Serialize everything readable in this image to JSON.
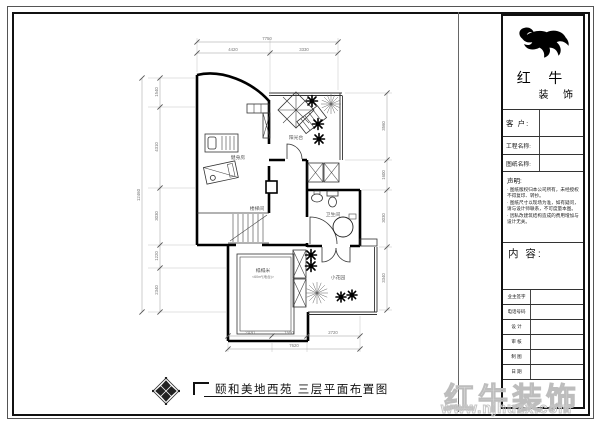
{
  "title_block": {
    "brand": {
      "line1": "红 牛",
      "line2": "装 饰"
    },
    "fields": [
      {
        "label": "客 户:"
      },
      {
        "label": "工程名称:"
      },
      {
        "label": "图纸名称:"
      }
    ],
    "statement": {
      "title": "声明:",
      "items": [
        "图纸版权归本公司所有，未经授权不得复印、转抄。",
        "图纸尺寸以现场为准，如有疑问，请与设计师联系，不可度量本图。",
        "因私改建筑结构造成的费用增加与设计无关。"
      ]
    },
    "content_label": "内 容:",
    "sign_rows": [
      {
        "label": "业主签字"
      },
      {
        "label": "电话号码"
      },
      {
        "label": "设 计"
      },
      {
        "label": "审 核"
      },
      {
        "label": "制 图"
      },
      {
        "label": "日 期"
      }
    ]
  },
  "plan": {
    "rooms": {
      "gym": "健身房",
      "terrace": "阳光台",
      "stairs": "楼梯间",
      "bathroom": "卫生间",
      "tatami": "榻榻米",
      "tatami_note": "<60m²(地台)>",
      "garden": "小花园"
    },
    "dims": {
      "top": {
        "overall": "7750",
        "seg1": "4420",
        "seg2": "3330"
      },
      "bottom": {
        "overall": "7620",
        "seg1": "2430",
        "seg2": "1590",
        "seg3": "2720"
      },
      "left": {
        "overall": "12460",
        "seg1": "1540",
        "seg2": "4310",
        "seg3": "3030",
        "seg4": "1220",
        "seg5": "2340"
      },
      "right": {
        "seg1": "3560",
        "seg2": "1600",
        "seg3": "3030",
        "seg4": "3340"
      }
    }
  },
  "footer": {
    "drawing_title": "颐和美地西苑  三层平面布置图"
  },
  "watermark": {
    "brand": "红牛装饰",
    "url": "www.njhuzx.com"
  },
  "colors": {
    "line": "#111111",
    "dim": "#8a8a8a",
    "watermark": "#c0c0c0"
  }
}
